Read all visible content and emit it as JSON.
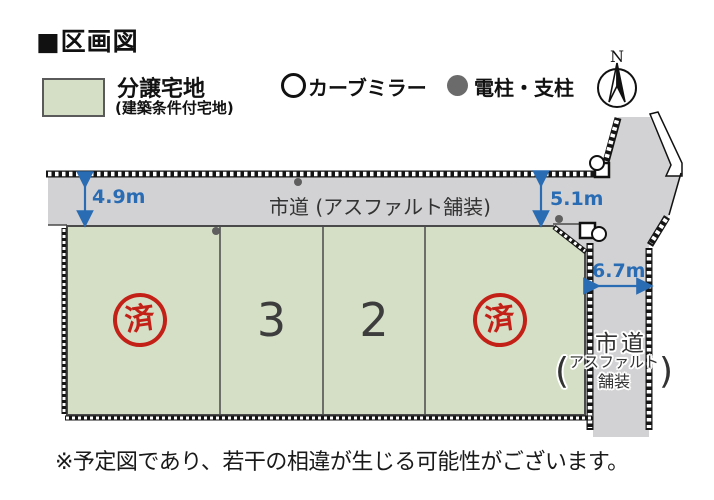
{
  "title": "■区画図",
  "legend": {
    "lot_label": "分譲宅地",
    "lot_sublabel": "(建築条件付宅地)",
    "mirror_label": "カーブミラー",
    "pole_label": "電柱・支柱",
    "compass_label": "N"
  },
  "map": {
    "road_top_label": "市道 (アスファルト舗装)",
    "road_right_label": "市道",
    "road_right_paren_open": "(",
    "road_right_sub_line1": "アスファルト",
    "road_right_sub_line2": "舗装",
    "road_right_paren_close": ")",
    "dim_left": "4.9m",
    "dim_mid": "5.1m",
    "dim_right": "6.7m",
    "plots": [
      {
        "name": "plot-west",
        "stamp": "済",
        "status": "sold"
      },
      {
        "name": "plot-3",
        "number": "3"
      },
      {
        "name": "plot-2",
        "number": "2"
      },
      {
        "name": "plot-east",
        "stamp": "済",
        "status": "sold"
      }
    ]
  },
  "footnote": "※予定図であり、若干の相違が生じる可能性がございます。",
  "colors": {
    "lot_green": "#d4dfc6",
    "road_gray": "#d2d2d4",
    "dimension_blue": "#2a6cb3",
    "stamp_red": "#c32017",
    "pole_gray": "#5f5f5f"
  }
}
